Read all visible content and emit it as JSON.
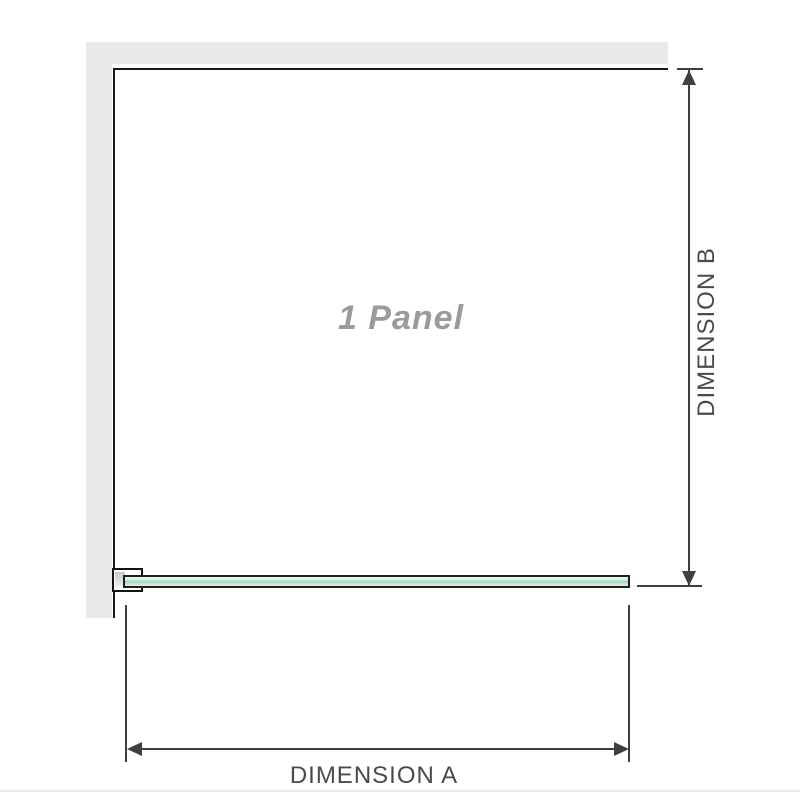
{
  "diagram": {
    "title": "Shower panel installation diagram",
    "panel_label": "1 Panel",
    "dimensions": {
      "a_label": "DIMENSION A",
      "b_label": "DIMENSION B"
    },
    "colors": {
      "wall_gray": "#e9e9e9",
      "panel_outline": "#1a1a1a",
      "dimension_lines": "#3f3f3f",
      "dimension_text": "#4a4a4a",
      "panel_label_text": "#9b9b9b",
      "glass_green": "#9ed3b3",
      "glass_green_light": "#d7efe1",
      "bracket_pad_gray": "#c9c9c9",
      "footer_line": "#eeebe1"
    }
  }
}
